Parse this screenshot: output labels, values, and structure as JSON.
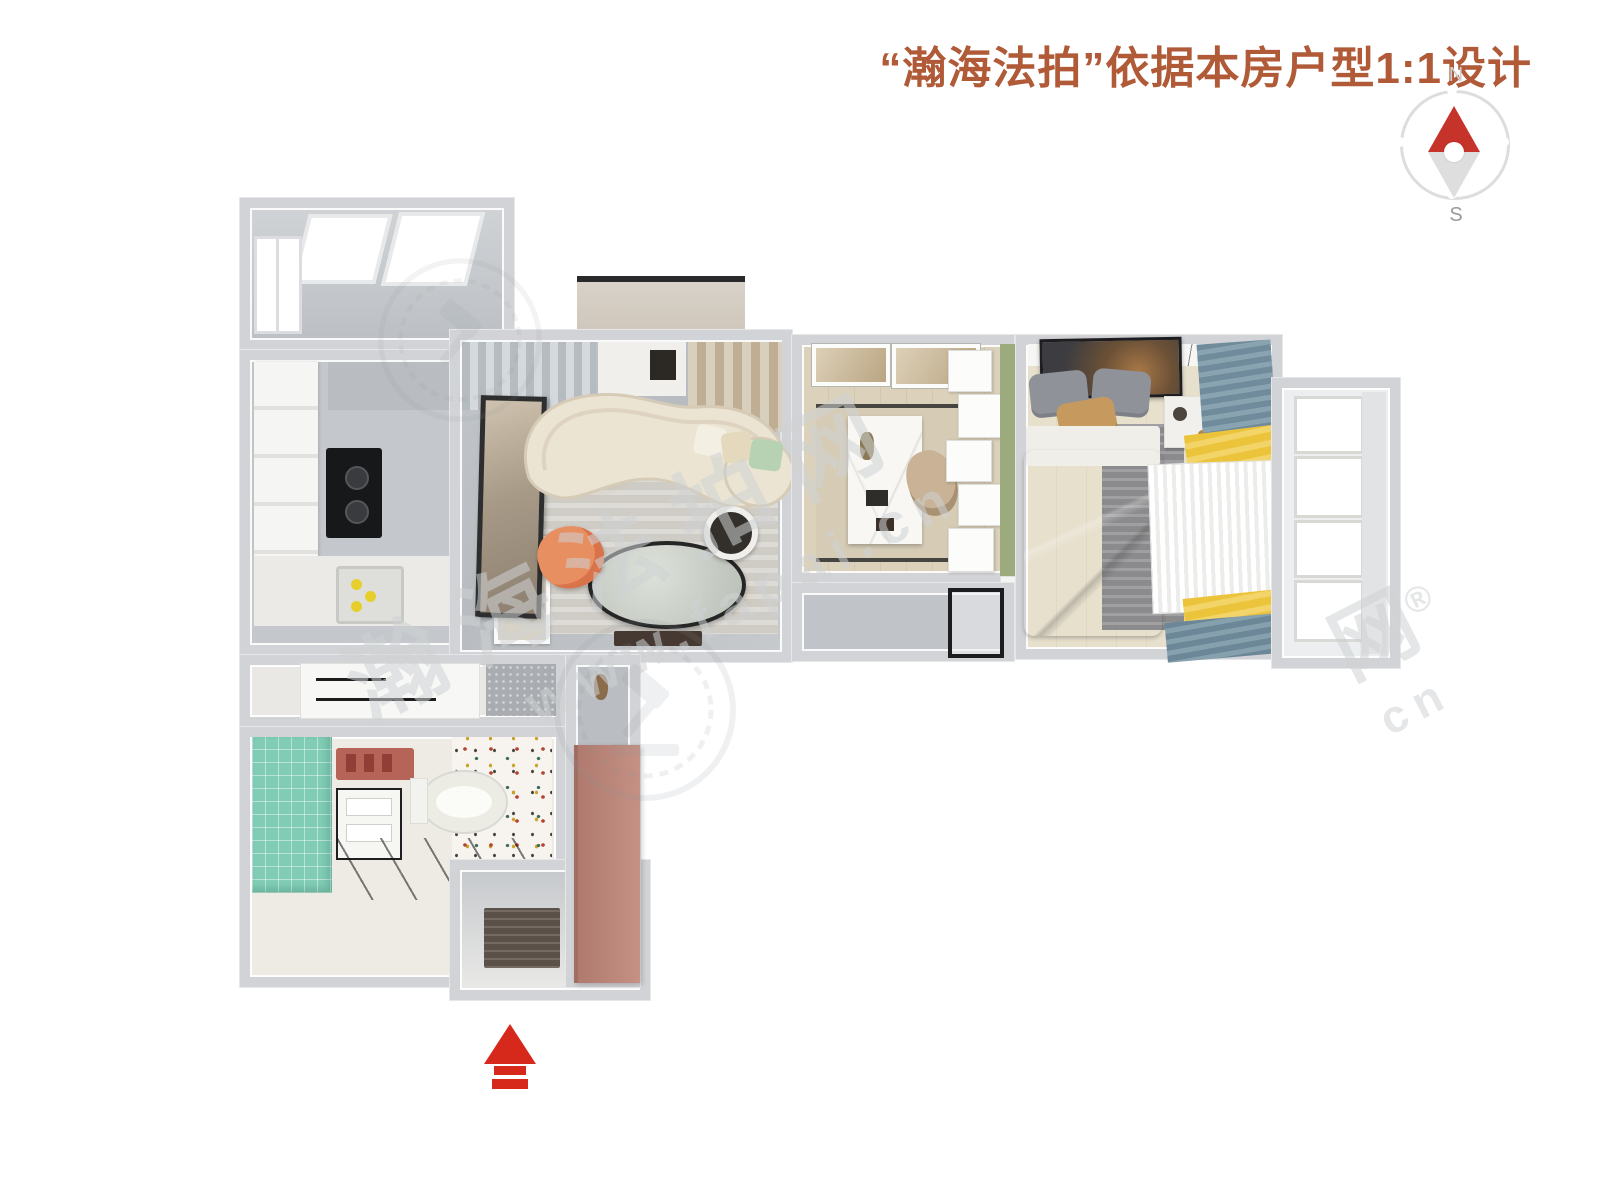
{
  "header": {
    "title": "“瀚海法拍”依据本房户型1:1设计"
  },
  "compass": {
    "north_label": "N",
    "south_label": "S"
  },
  "watermarks": {
    "brand": "瀚海法拍网",
    "url": "www.fapai.cn",
    "partial_char": "网",
    "registered": "®",
    "partial_url": "cn"
  },
  "palette": {
    "title_text": "#b05a38",
    "compass_north_needle": "#c6332a",
    "compass_south_needle": "#dededf",
    "entrance_arrow": "#d7281c",
    "wall": "#d2d3d6",
    "green_accent_wall": "#9cab7d",
    "teal_tile_wall": "#80ccb5",
    "pink_entry_cabinet": "#bd8a7d",
    "yellow_curtain": "#ecc43c",
    "blue_curtain": "#6f8b9c",
    "sofa_cream": "#ece4d3",
    "orange_chair": "#e88f62",
    "marble_floor": "#c0c4c8",
    "wood_floor_study": "#dcd2bb",
    "wood_floor_bedroom": "#e7e0cd"
  }
}
